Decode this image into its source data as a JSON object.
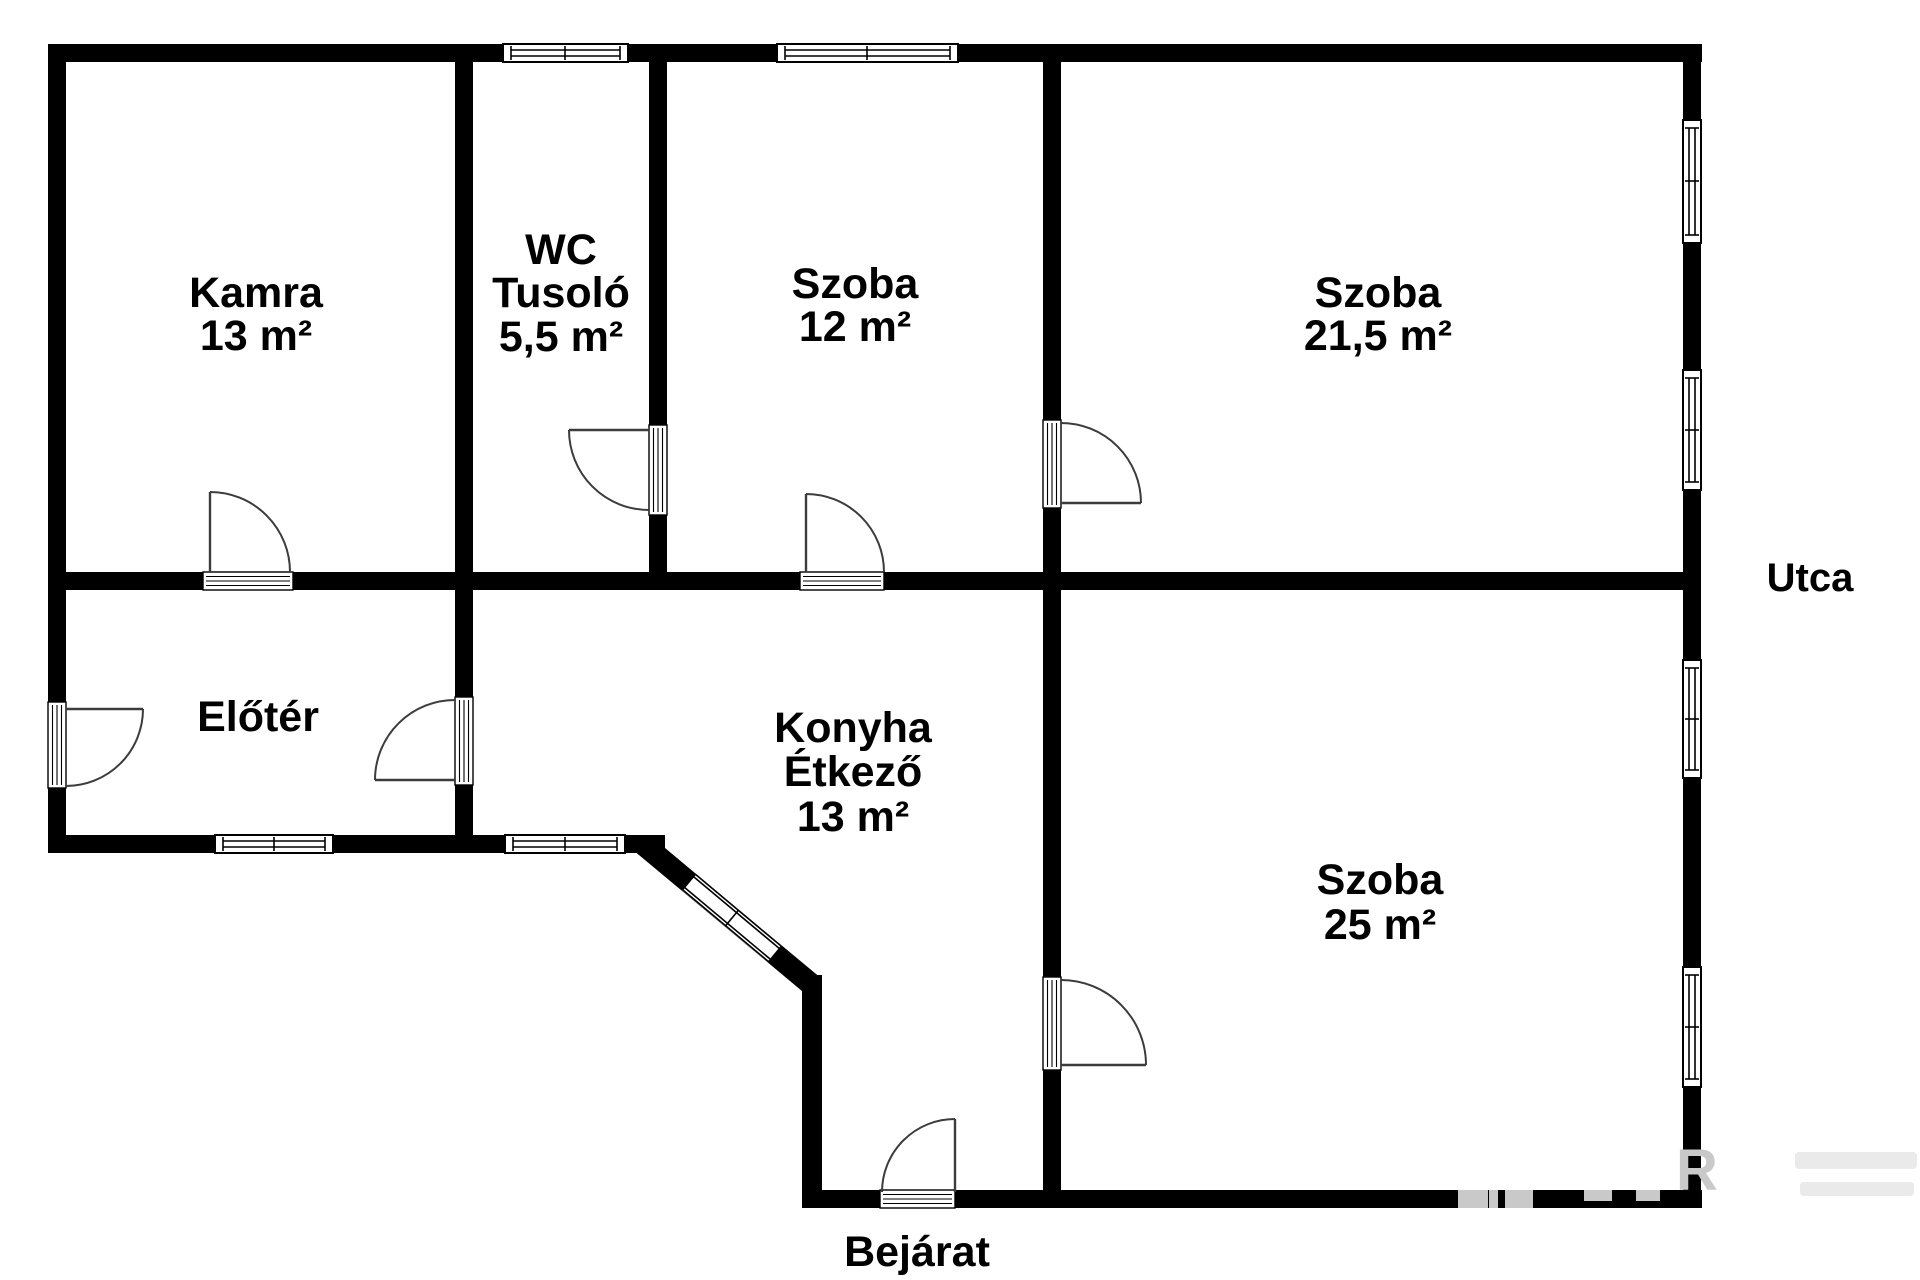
{
  "rooms": [
    {
      "key": "kamra",
      "lines": [
        "Kamra",
        "13 m²"
      ]
    },
    {
      "key": "wc-tusolo",
      "lines": [
        "WC",
        "Tusoló",
        "5,5 m²"
      ]
    },
    {
      "key": "szoba-12",
      "lines": [
        "Szoba",
        "12 m²"
      ]
    },
    {
      "key": "szoba-21-5",
      "lines": [
        "Szoba",
        "21,5 m²"
      ]
    },
    {
      "key": "eloter",
      "lines": [
        "Előtér"
      ]
    },
    {
      "key": "konyha-etkezo",
      "lines": [
        "Konyha",
        "Étkező",
        "13 m²"
      ]
    },
    {
      "key": "szoba-25",
      "lines": [
        "Szoba",
        "25 m²"
      ]
    }
  ],
  "labels": {
    "street": "Utca",
    "entrance": "Bejárat"
  },
  "watermark": {
    "corner_letter": "R"
  },
  "colors": {
    "wall": "#000000",
    "background": "#ffffff",
    "door_stroke": "#3c3c3c",
    "watermark_gray": "#c9c9c9",
    "watermark_faint": "#eaeaea"
  }
}
